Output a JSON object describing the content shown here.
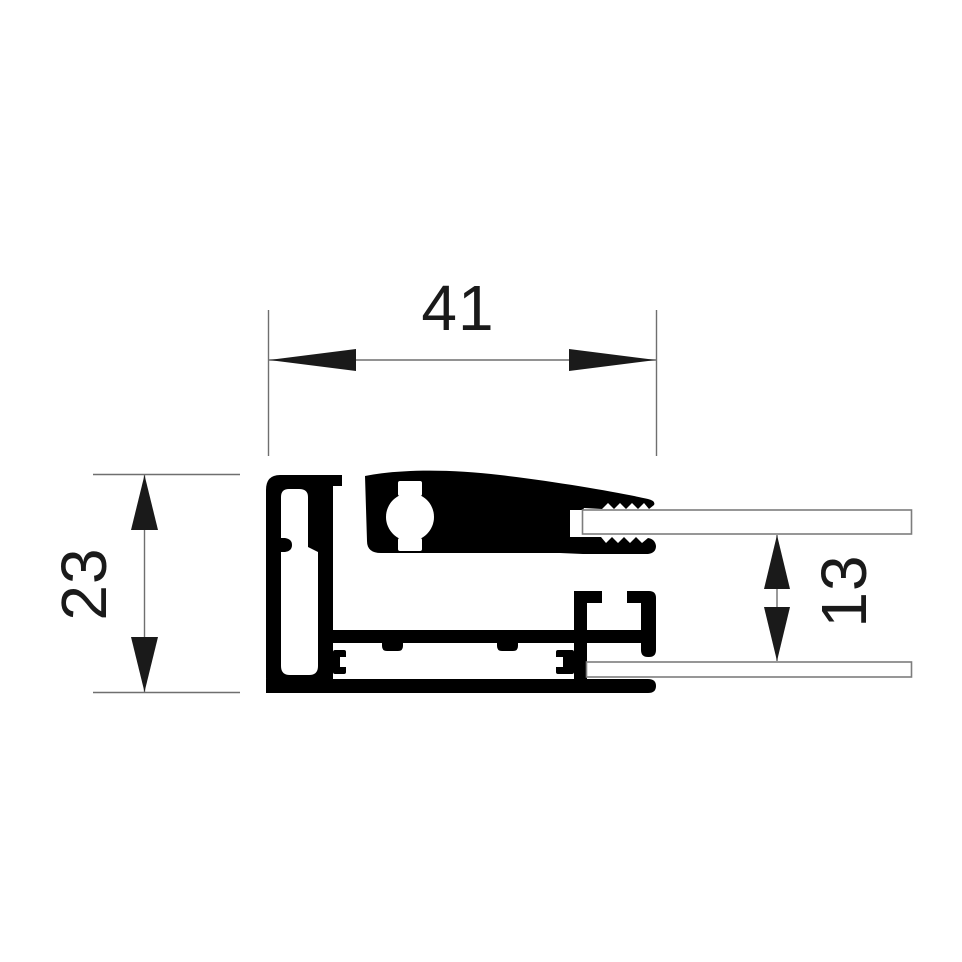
{
  "colors": {
    "background": "#ffffff",
    "profile": "#000000",
    "line": "#6f6f6f",
    "text": "#1a1a1a",
    "glass_edge": "#7d7d7d"
  },
  "dimensions": {
    "overall_width": {
      "label": "41"
    },
    "overall_height": {
      "label": "23"
    },
    "glass_gap": {
      "label": "13"
    }
  }
}
